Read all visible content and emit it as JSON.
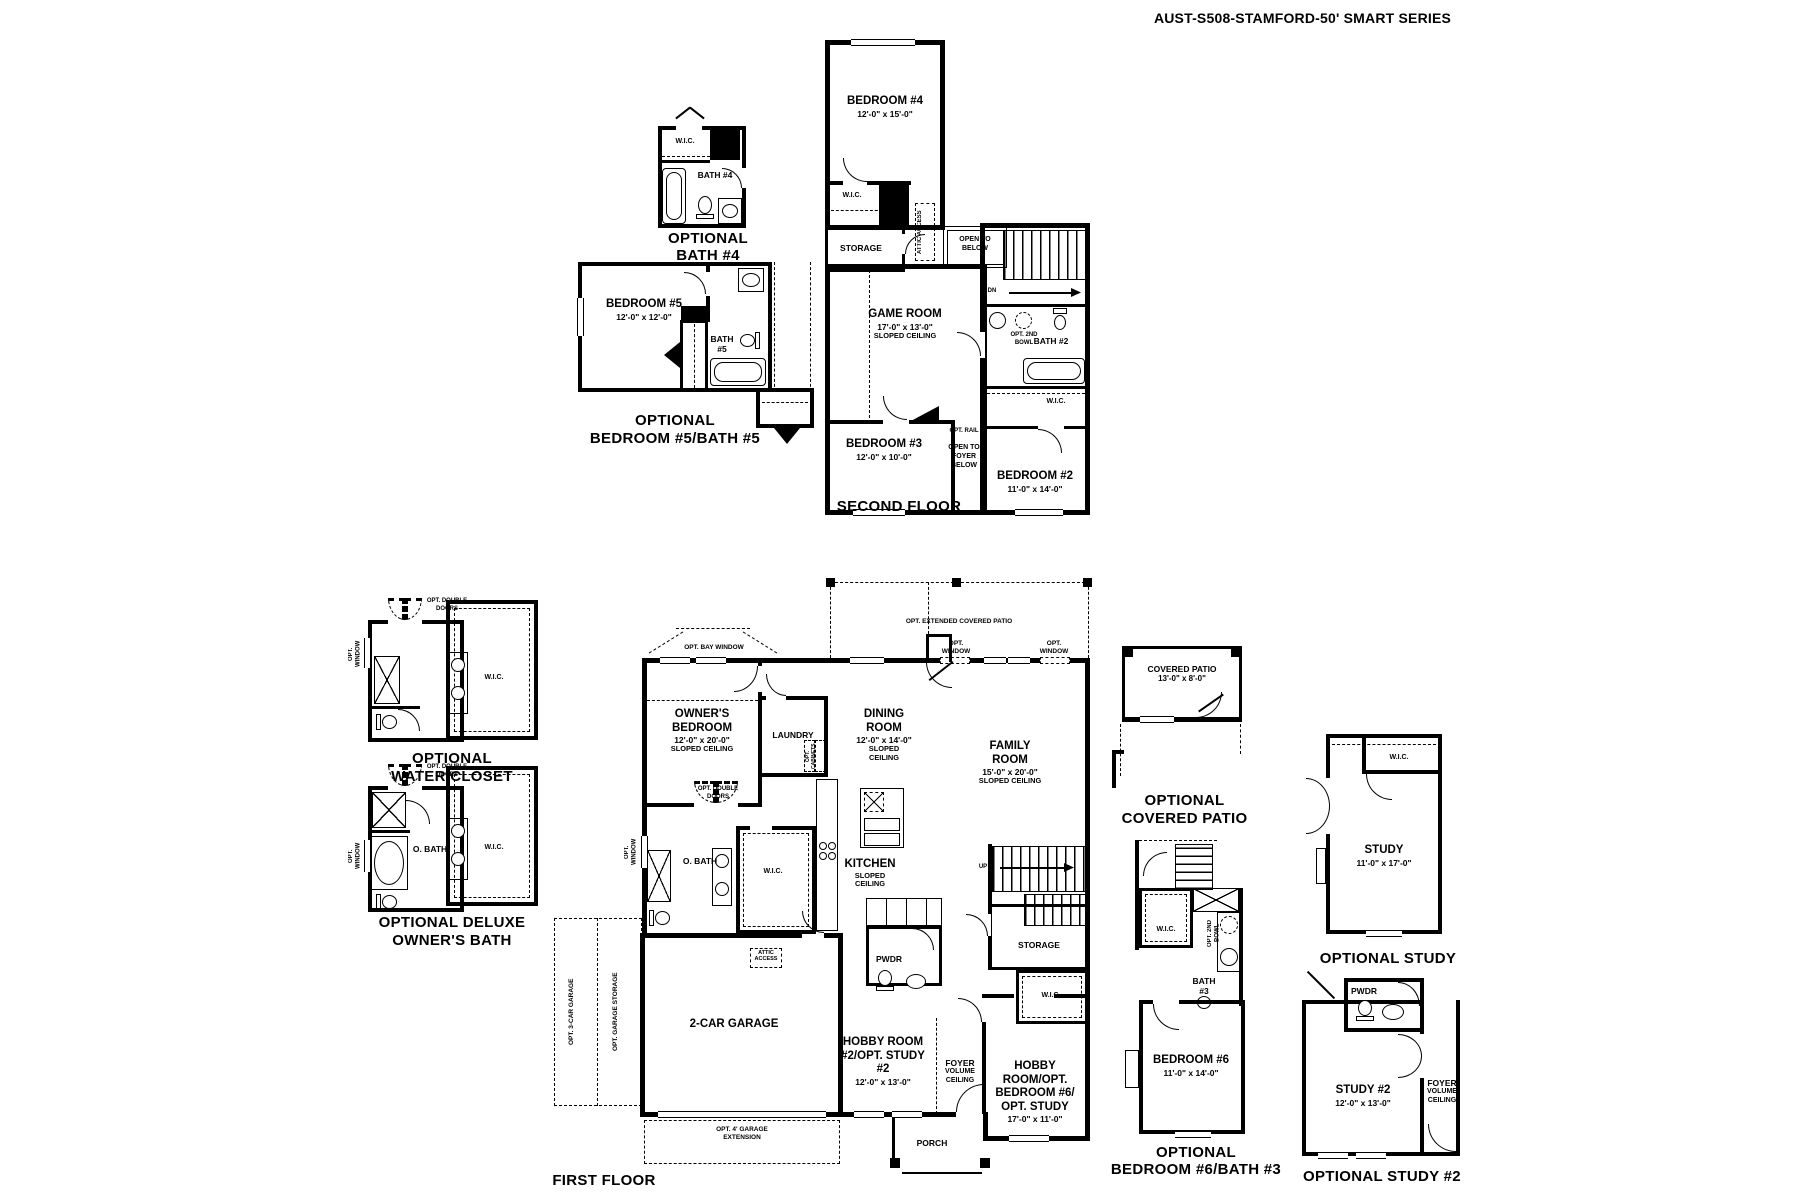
{
  "title": "AUST-S508-STAMFORD-50' SMART SERIES",
  "captions": {
    "second_floor": "SECOND FLOOR",
    "first_floor": "FIRST FLOOR",
    "optional": "OPTIONAL",
    "bath4": "BATH #4",
    "bed5_bath5": "BEDROOM #5/BATH #5",
    "water_closet": "WATER CLOSET",
    "optional_deluxe": "OPTIONAL DELUXE",
    "owners_bath": "OWNER'S BATH",
    "covered_patio": "COVERED PATIO",
    "optional_study": "OPTIONAL STUDY",
    "bed6_bath3": "BEDROOM #6/BATH #3",
    "optional_study2": "OPTIONAL STUDY #2"
  },
  "rooms": {
    "bedroom4": {
      "name": "BEDROOM #4",
      "dims": "12'-0\" x 15'-0\""
    },
    "bedroom3": {
      "name": "BEDROOM #3",
      "dims": "12'-0\" x 10'-0\""
    },
    "bedroom2": {
      "name": "BEDROOM #2",
      "dims": "11'-0\" x 14'-0\""
    },
    "bedroom5": {
      "name": "BEDROOM #5",
      "dims": "12'-0\" x 12'-0\""
    },
    "bedroom6": {
      "name": "BEDROOM #6",
      "dims": "11'-0\" x 14'-0\""
    },
    "game_room": {
      "name": "GAME ROOM",
      "dims": "17'-0\" x 13'-0\"",
      "note": "SLOPED CEILING"
    },
    "owners_bedroom": {
      "name": "OWNER'S BEDROOM",
      "dims": "12'-0\" x 20'-0\"",
      "note": "SLOPED CEILING"
    },
    "dining": {
      "name": "DINING ROOM",
      "dims": "12'-0\" x 14'-0\"",
      "note": "SLOPED CEILING"
    },
    "family": {
      "name": "FAMILY ROOM",
      "dims": "15'-0\" x 20'-0\"",
      "note": "SLOPED CEILING"
    },
    "kitchen": {
      "name": "KITCHEN",
      "note": "SLOPED CEILING"
    },
    "covered_patio": {
      "name": "COVERED PATIO",
      "dims": "13'-0\" x 8'-0\""
    },
    "study": {
      "name": "STUDY",
      "dims": "11'-0\" x 17'-0\""
    },
    "study2": {
      "name": "STUDY #2",
      "dims": "12'-0\" x 13'-0\""
    },
    "hobby2": {
      "name": "HOBBY ROOM #2/OPT. STUDY #2",
      "dims": "12'-0\" x 13'-0\""
    },
    "hobby6": {
      "name": "HOBBY ROOM/OPT. BEDROOM #6/ OPT. STUDY",
      "dims": "17'-0\" x 11'-0\""
    },
    "foyer": {
      "name": "FOYER",
      "note": "VOLUME CEILING"
    },
    "garage": {
      "name": "2-CAR GARAGE"
    },
    "laundry": "LAUNDRY",
    "bath2": "BATH #2",
    "bath3": "BATH #3",
    "bath4": "BATH #4",
    "bath5": "BATH #5",
    "obath": "O. BATH",
    "pwdr": "PWDR",
    "storage": "STORAGE",
    "wic": "W.I.C.",
    "porch": "PORCH"
  },
  "ann": {
    "open_to_below": "OPEN TO BELOW",
    "open_to_foyer": "OPEN TO FOYER BELOW",
    "opt_rail": "OPT. RAIL",
    "dn": "DN",
    "up": "UP",
    "attic": "ATTIC ACCESS",
    "opt_2nd_bowl": "OPT. 2ND BOWL",
    "opt_bay_window": "OPT. BAY WINDOW",
    "opt_ext_patio": "OPT. EXTENDED COVERED PATIO",
    "opt_window": "OPT. WINDOW",
    "opt_double_doors": "OPT. DOUBLE DOORS",
    "opt_cabinets": "OPT. CABINETS",
    "opt_3car": "OPT. 3-CAR GARAGE",
    "opt_garage_storage": "OPT. GARAGE STORAGE",
    "opt_garage_ext": "OPT. 4' GARAGE EXTENSION"
  }
}
